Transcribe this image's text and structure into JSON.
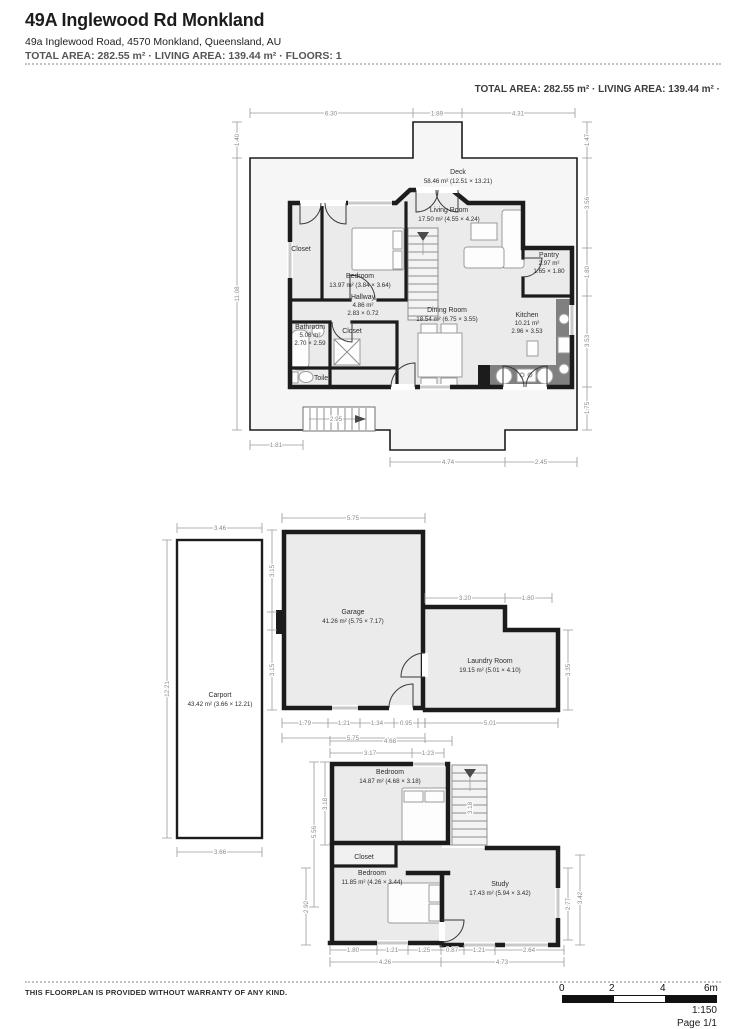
{
  "header": {
    "title": "49A Inglewood Rd Monkland",
    "address": "49a Inglewood Road, 4570 Monkland, Queensland, AU",
    "summary": "TOTAL AREA: 282.55 m² · LIVING AREA: 139.44 m² · FLOORS: 1",
    "summary_right": "TOTAL AREA: 282.55 m² · LIVING AREA: 139.44 m² ·"
  },
  "rooms": {
    "deck": {
      "name": "Deck",
      "area": "58.46 m² (12.51 × 13.21)"
    },
    "living": {
      "name": "Living Room",
      "area": "17.50 m² (4.55 × 4.24)"
    },
    "closet_main": {
      "name": "Closet"
    },
    "bedroom_main": {
      "name": "Bedroom",
      "area": "13.97 m² (3.84 × 3.64)"
    },
    "hallway": {
      "name": "Hallway",
      "area": "4.86 m²",
      "dims": "2.83 × 0.72"
    },
    "bathroom": {
      "name": "Bathroom",
      "area": "5.08 m²",
      "dims": "2.70 × 2.59"
    },
    "closet_hall": {
      "name": "Closet"
    },
    "toilet": {
      "name": "Toilet"
    },
    "dining": {
      "name": "Dining Room",
      "area": "18.54 m² (6.75 × 3.55)"
    },
    "pantry": {
      "name": "Pantry",
      "area": "2.97 m²",
      "dims": "1.65 × 1.80"
    },
    "kitchen": {
      "name": "Kitchen",
      "area": "10.21 m²",
      "dims": "2.96 × 3.53"
    },
    "carport": {
      "name": "Carport",
      "area": "43.42 m² (3.66 × 12.21)"
    },
    "garage": {
      "name": "Garage",
      "area": "41.26 m² (5.75 × 7.17)"
    },
    "laundry": {
      "name": "Laundry Room",
      "area": "19.15 m² (5.01 × 4.10)"
    },
    "bedroom2": {
      "name": "Bedroom",
      "area": "14.87 m² (4.68 × 3.18)"
    },
    "closet2": {
      "name": "Closet"
    },
    "bedroom3": {
      "name": "Bedroom",
      "area": "11.85 m² (4.26 × 3.44)"
    },
    "study": {
      "name": "Study",
      "area": "17.43 m² (5.94 × 3.42)"
    }
  },
  "dims": {
    "m_top1": "6.30",
    "m_top2": "1.89",
    "m_top3": "4.31",
    "m_left1": "1.40",
    "m_left2": "11.08",
    "m_r1": "1.47",
    "m_r2": "3.56",
    "m_r3": "1.80",
    "m_r4": "3.53",
    "m_r5": "1.75",
    "m_b1": "1.81",
    "m_b2": "4.74",
    "m_b3": "2.45",
    "m_stairs": "2.95",
    "cp_top": "3.46",
    "cp_left": "12.21",
    "cp_bot": "3.66",
    "g_top": "5.75",
    "g_l1": "3.15",
    "g_l2": "3.15",
    "g_b1": "1.79",
    "g_b2": "1.21",
    "g_b3": "1.34",
    "g_b4": "0.95",
    "g_bt": "5.75",
    "l_t1": "3.20",
    "l_t2": "1.80",
    "l_r": "3.35",
    "l_b": "5.01",
    "b_top": "4.68",
    "b_t1": "3.17",
    "b_t2": "1.23",
    "b_l1": "5.56",
    "b_l2": "3.18",
    "b_st": "3.18",
    "b_l3": "2.92",
    "b_b1": "1.80",
    "b_b2": "1.21",
    "b_b3": "1.25",
    "b_b4": "0.87",
    "b_b5": "1.21",
    "b_b6": "2.64",
    "b_bt1": "4.26",
    "b_bt2": "4.73",
    "s_r1": "2.77",
    "s_r2": "3.42"
  },
  "footer": {
    "disclaimer": "THIS FLOORPLAN IS PROVIDED WITHOUT WARRANTY OF ANY KIND.",
    "scale_0": "0",
    "scale_2": "2",
    "scale_4": "4",
    "scale_6": "6m",
    "ratio": "1:150",
    "page": "Page 1/1"
  },
  "colors": {
    "wall": "#1c1c1c",
    "room_fill": "#ebebeb",
    "deck_fill": "#f6f6f6",
    "dim_text": "#8a8a8a"
  }
}
